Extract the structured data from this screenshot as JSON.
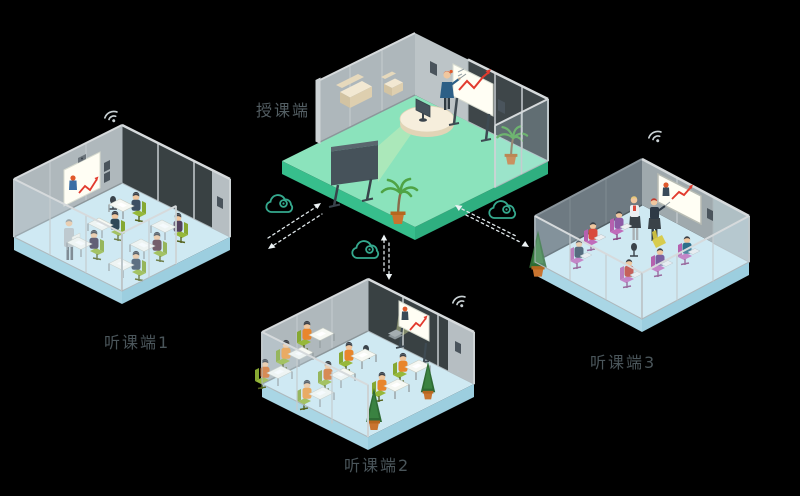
{
  "scene": {
    "background_color": "#000000",
    "rooms": [
      {
        "id": "teaching",
        "label": "授课端",
        "floor_color": "#8BE3BC",
        "wifi": false,
        "wall_screen": "whiteboard-red-trend-chart",
        "people_visible": 1
      },
      {
        "id": "listening-1",
        "label": "听课端1",
        "floor_color": "#CFE9F2",
        "wifi": true,
        "wall_screen": "remote-teacher-with-red-chart",
        "people_visible": 7
      },
      {
        "id": "listening-2",
        "label": "听课端2",
        "floor_color": "#CFE9F2",
        "wifi": true,
        "wall_screen": "remote-teacher-with-red-chart",
        "people_visible": 8
      },
      {
        "id": "listening-3",
        "label": "听课端3",
        "floor_color": "#CFE9F2",
        "wifi": true,
        "wall_screen": "remote-teacher-with-red-chart",
        "people_visible": 8
      }
    ],
    "connections": [
      {
        "from": "teaching",
        "to": "listening-1",
        "via": "cloud-icon",
        "style": "dashed-double-arrow"
      },
      {
        "from": "teaching",
        "to": "listening-2",
        "via": "cloud-icon",
        "style": "dashed-double-arrow"
      },
      {
        "from": "teaching",
        "to": "listening-3",
        "via": "cloud-icon",
        "style": "dashed-double-arrow"
      }
    ],
    "icons": {
      "wifi": "wifi-icon",
      "cloud": "cloud-network-icon",
      "chart": "red-zigzag-trend-line"
    },
    "colors": {
      "teaching_floor": "#8BE3BC",
      "teaching_floor_side": "#37BE8C",
      "listening_floor": "#CFE9F2",
      "listening_floor_side": "#A9D6E5",
      "wall_gray": "#AFB8BC",
      "cloud_stroke": "#35A98E",
      "wifi_gray": "#C9D1D4",
      "link_dash": "#DFE7EA",
      "chart_red": "#E23B2E",
      "label_text": "#4A555A",
      "chair_green": "#96B83A",
      "chair_purple": "#C06BBB",
      "vest_orange": "#E8862C"
    }
  }
}
